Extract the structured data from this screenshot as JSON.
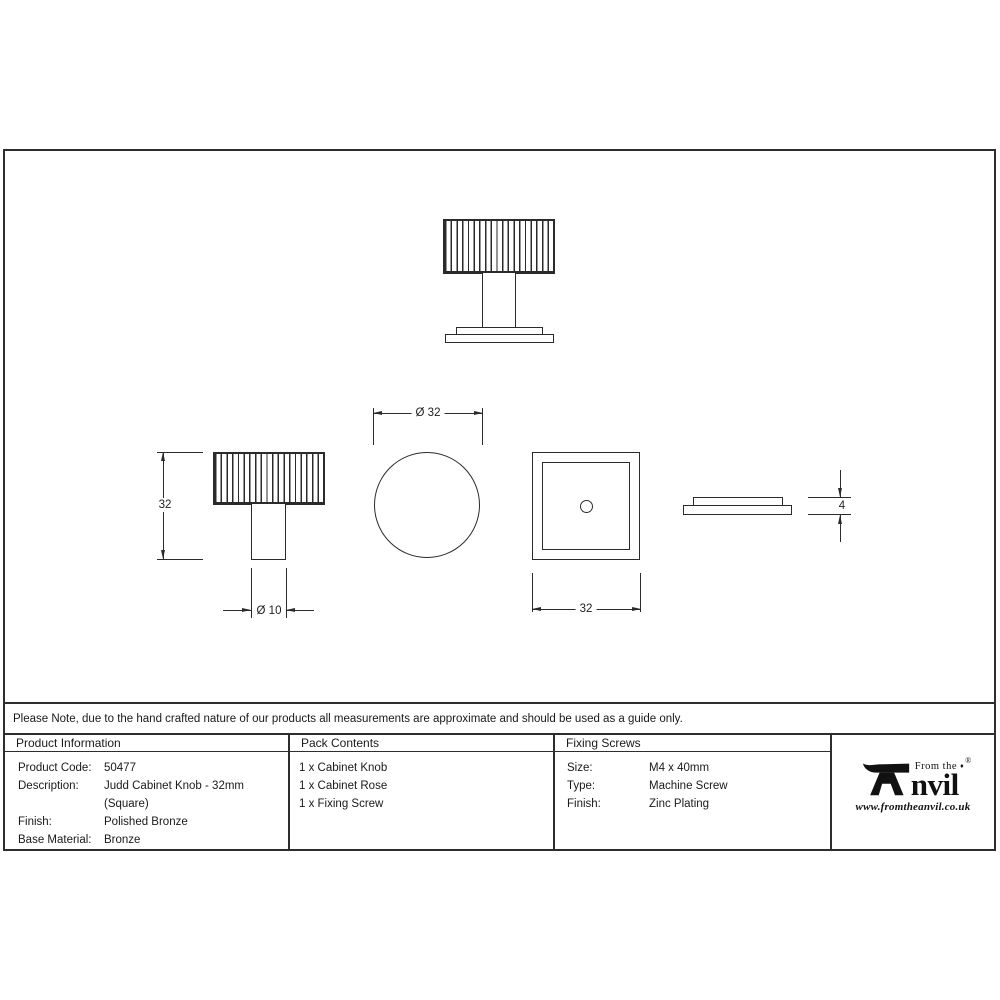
{
  "note": "Please Note, due to the hand crafted nature of our products all measurements are approximate and should be used as a guide only.",
  "dims": {
    "knob_height": "32",
    "stem_diameter": "Ø 10",
    "knob_diameter": "Ø 32",
    "rose_width": "32",
    "rose_thickness": "4"
  },
  "table": {
    "product_information": {
      "header": "Product Information",
      "rows": [
        {
          "label": "Product Code:",
          "value": "50477"
        },
        {
          "label": "Description:",
          "value": "Judd Cabinet Knob - 32mm (Square)"
        },
        {
          "label": "Finish:",
          "value": "Polished Bronze"
        },
        {
          "label": "Base Material:",
          "value": "Bronze"
        }
      ]
    },
    "pack_contents": {
      "header": "Pack Contents",
      "items": [
        "1 x Cabinet Knob",
        "1 x Cabinet Rose",
        "1 x Fixing Screw"
      ]
    },
    "fixing_screws": {
      "header": "Fixing Screws",
      "rows": [
        {
          "label": "Size:",
          "value": "M4 x 40mm"
        },
        {
          "label": "Type:",
          "value": "Machine Screw"
        },
        {
          "label": "Finish:",
          "value": "Zinc Plating"
        }
      ]
    }
  },
  "logo": {
    "prefix": "From the",
    "diamond": "♦",
    "name_rest": "nvil",
    "registered": "®",
    "website": "www.fromtheanvil.co.uk"
  },
  "colors": {
    "line": "#2b2b2b",
    "text": "#1a1a1a",
    "background": "#ffffff"
  }
}
